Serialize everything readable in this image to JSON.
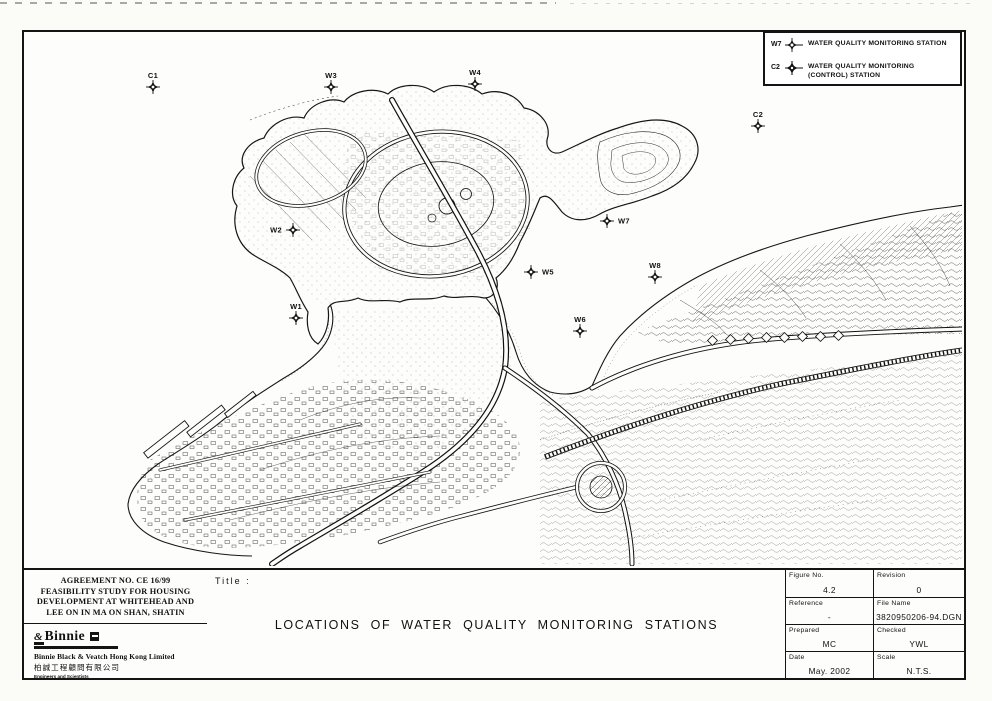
{
  "legend": {
    "items": [
      {
        "tag": "W7",
        "text": "WATER QUALITY MONITORING STATION"
      },
      {
        "tag": "C2",
        "text": "WATER QUALITY MONITORING (CONTROL) STATION"
      }
    ]
  },
  "stations": [
    {
      "id": "C1",
      "x": 153,
      "y": 87,
      "label_pos": "above",
      "type": "control"
    },
    {
      "id": "W3",
      "x": 331,
      "y": 87,
      "label_pos": "above",
      "type": "monitoring"
    },
    {
      "id": "W4",
      "x": 475,
      "y": 84,
      "label_pos": "above",
      "type": "monitoring"
    },
    {
      "id": "C2",
      "x": 758,
      "y": 126,
      "label_pos": "above",
      "type": "control"
    },
    {
      "id": "W2",
      "x": 293,
      "y": 230,
      "label_pos": "left",
      "type": "monitoring"
    },
    {
      "id": "W7",
      "x": 607,
      "y": 221,
      "label_pos": "right",
      "type": "monitoring"
    },
    {
      "id": "W5",
      "x": 531,
      "y": 272,
      "label_pos": "right",
      "type": "monitoring"
    },
    {
      "id": "W8",
      "x": 655,
      "y": 277,
      "label_pos": "above",
      "type": "monitoring"
    },
    {
      "id": "W1",
      "x": 296,
      "y": 318,
      "label_pos": "above",
      "type": "monitoring"
    },
    {
      "id": "W6",
      "x": 580,
      "y": 331,
      "label_pos": "above",
      "type": "monitoring"
    }
  ],
  "title_block": {
    "project_lines": [
      "AGREEMENT NO. CE 16/99",
      "FEASIBILITY STUDY FOR HOUSING",
      "DEVELOPMENT AT WHITEHEAD AND",
      "LEE ON IN MA ON SHAN, SHATIN"
    ],
    "company": {
      "logo_amp": "&",
      "logo_text": "Binnie",
      "name": "Binnie Black & Veatch Hong Kong Limited",
      "name_cn": "柏誠工程顧問有限公司",
      "tagline": "Engineers and Scientists"
    },
    "title_label": "Title :",
    "drawing_title": "LOCATIONS OF WATER QUALITY MONITORING STATIONS",
    "info": {
      "figure_no_label": "Figure No.",
      "figure_no": "4.2",
      "revision_label": "Revision",
      "revision": "0",
      "reference_label": "Reference",
      "reference": "-",
      "file_name_label": "File Name",
      "file_name": "3820950206-94.DGN",
      "prepared_label": "Prepared",
      "prepared": "MC",
      "checked_label": "Checked",
      "checked": "YWL",
      "date_label": "Date",
      "date": "May. 2002",
      "scale_label": "Scale",
      "scale": "N.T.S."
    }
  }
}
